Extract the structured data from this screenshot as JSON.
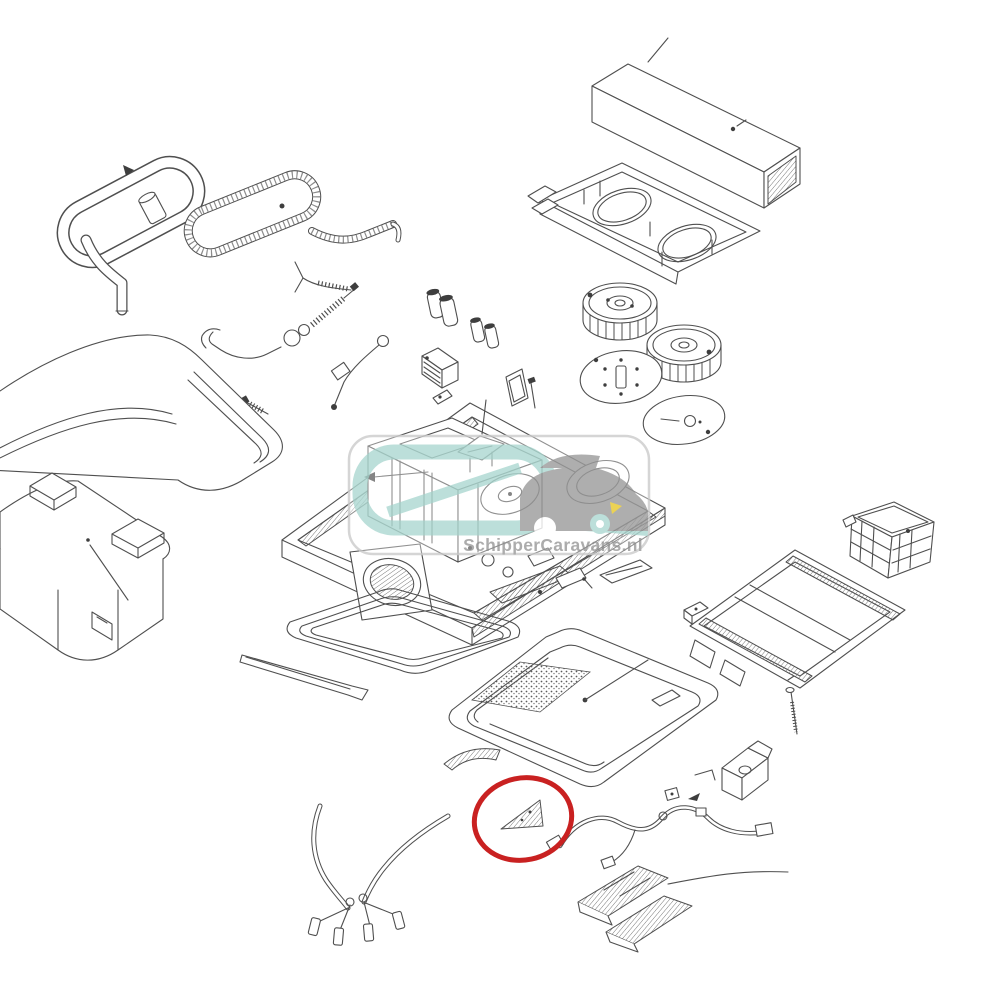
{
  "diagram": {
    "type": "exploded-view-parts-diagram",
    "subject": "rooftop air conditioner unit",
    "background_color": "#ffffff",
    "line_color": "#4f4f4f",
    "parts": [
      {
        "name": "grab-handle-tube",
        "description": "bent tubular handle loop, top left"
      },
      {
        "name": "condensate-hose",
        "description": "corrugated hose loop with long tail"
      },
      {
        "name": "roof-cover-top",
        "description": "smooth outer roof cowl shell, left"
      },
      {
        "name": "roof-cover-base",
        "description": "lower cover shell with two raised bosses"
      },
      {
        "name": "control-box",
        "description": "rectangular electronic control box, top right"
      },
      {
        "name": "blower-duct-tray",
        "description": "air duct tray with two circular fan openings"
      },
      {
        "name": "blower-wheel-1",
        "description": "centrifugal fan wheel"
      },
      {
        "name": "blower-wheel-2",
        "description": "centrifugal fan wheel"
      },
      {
        "name": "fan-disc-1",
        "description": "round mounting disc with screw holes"
      },
      {
        "name": "fan-disc-2",
        "description": "round mounting disc with slot"
      },
      {
        "name": "capacitor-set",
        "description": "four small run capacitors"
      },
      {
        "name": "relay-module",
        "description": "finned relay / control module"
      },
      {
        "name": "mounting-clip",
        "description": "small fixing clip"
      },
      {
        "name": "cover-plate",
        "description": "small plate with pin"
      },
      {
        "name": "sensor-cables",
        "description": "sensor wires, springs and screws"
      },
      {
        "name": "main-unit-assembly",
        "description": "base pan with compressor, coils and blower outlet"
      },
      {
        "name": "roof-seal-gasket",
        "description": "rounded rectangular roof seal ring"
      },
      {
        "name": "seal-strip",
        "description": "flat L-shaped seal strip"
      },
      {
        "name": "air-distributor-box",
        "description": "inner ceiling air distribution frame"
      },
      {
        "name": "corner-vane",
        "description": "small triangular corner vane (highlighted)"
      },
      {
        "name": "trim-strip",
        "description": "small curved trim strip"
      },
      {
        "name": "wiring-harness",
        "description": "cable harness with connectors"
      },
      {
        "name": "mounting-bracket",
        "description": "small angled mounting bracket"
      },
      {
        "name": "air-outlet-grille-1",
        "description": "curved air outlet grille"
      },
      {
        "name": "air-outlet-grille-2",
        "description": "curved air outlet grille"
      },
      {
        "name": "power-cable",
        "description": "double cable with plug ends, bottom left"
      },
      {
        "name": "mounting-frame",
        "description": "flat mounting frame with rails, right"
      },
      {
        "name": "filter-basket",
        "description": "mesh filter basket, right"
      },
      {
        "name": "fixing-bolt",
        "description": "long threaded bolt"
      },
      {
        "name": "small-connector",
        "description": "small connector block"
      },
      {
        "name": "cover-plate-small",
        "description": "small flat cover plate with screw"
      }
    ]
  },
  "watermark": {
    "text": "SchipperCaravans.nl",
    "text_color": "#9b9b9b",
    "logo_teal": "#aed9d2",
    "logo_gray": "#9d9d9d",
    "logo_yellow": "#e7c92f",
    "panel_border": "#cccccc",
    "panel_fill": "rgba(255,255,255,0.45)"
  },
  "highlight": {
    "shape": "ellipse",
    "color": "#c92121",
    "cx": 523,
    "cy": 819,
    "rx": 49,
    "ry": 41,
    "stroke_width": 5,
    "marked_part": "corner-vane"
  }
}
